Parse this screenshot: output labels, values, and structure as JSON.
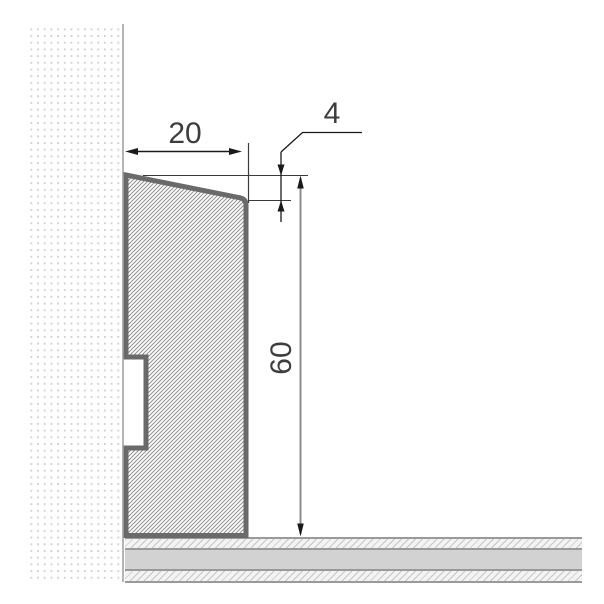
{
  "drawing": {
    "subject": "skirting-board cross-section with wall and floor",
    "dimensions": {
      "profile_width": {
        "value": "20"
      },
      "top_bevel": {
        "value": "4"
      },
      "profile_height": {
        "value": "60"
      }
    },
    "colors": {
      "background": "#ffffff",
      "wall_dots": "#d2d2d2",
      "wall_edge": "#b5b5b5",
      "profile_outline": "#6a6a6a",
      "profile_hatch": "#8f8f8f",
      "floor_solid": "#d2d2d2",
      "floor_separator": "#9a9a9a",
      "dimension_line": "#1a1a1a",
      "height_dimension_line": "#8c8c8c",
      "label_text": "#3d3d3d"
    }
  }
}
